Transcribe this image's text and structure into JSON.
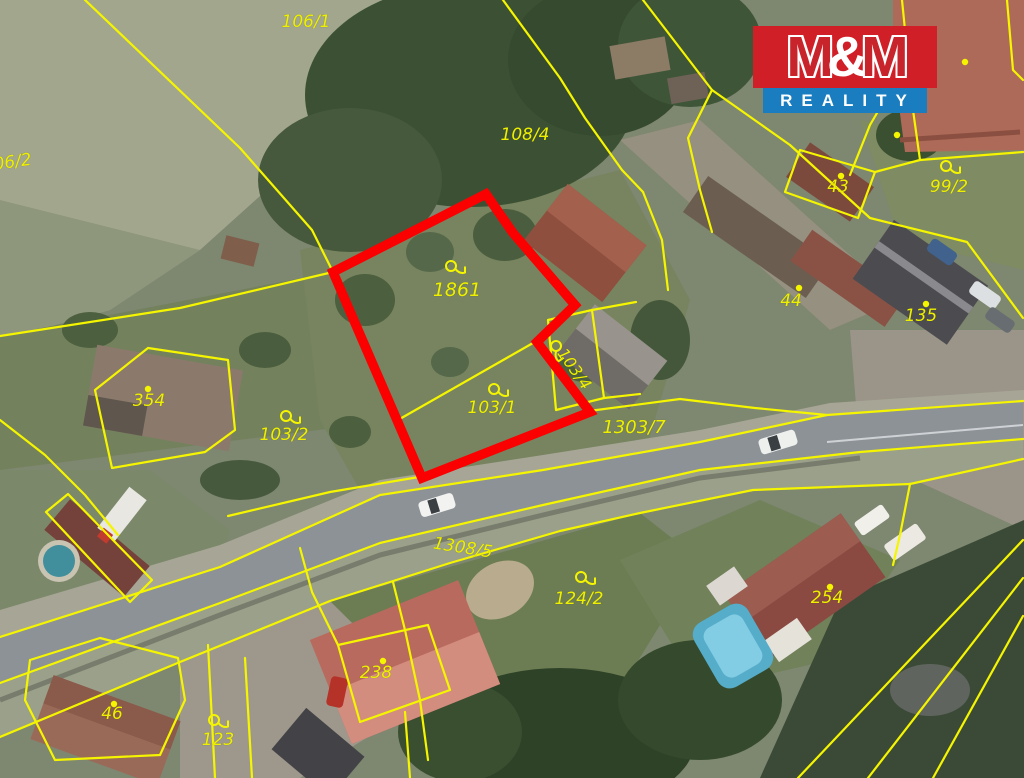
{
  "branding": {
    "m1": "M",
    "amp": "&",
    "m2": "M",
    "reality": "REALITY",
    "red": "#d01f26",
    "blue": "#1a7dc0"
  },
  "map": {
    "boundary_color": "#f5f500",
    "label_color": "#eef000",
    "highlight_parcel": {
      "number": "1861",
      "outline_color": "#fb0000",
      "points": "333,272 486,194 513,233 575,305 537,342 590,412 422,478"
    },
    "building_dots": [
      [
        965,
        62
      ],
      [
        897,
        135
      ]
    ],
    "parcel_labels": [
      {
        "text": "106/1",
        "x": 306,
        "y": 27,
        "rot": 0,
        "sym": "none",
        "size": 17
      },
      {
        "text": "106/2",
        "x": 8,
        "y": 168,
        "rot": -8,
        "sym": "none",
        "size": 17
      },
      {
        "text": "108/4",
        "x": 525,
        "y": 140,
        "rot": 0,
        "sym": "none",
        "size": 17
      },
      {
        "text": "1861",
        "x": 457,
        "y": 296,
        "rot": 0,
        "sym": "flag",
        "sx": 451,
        "sy": 266,
        "size": 19
      },
      {
        "text": "103/1",
        "x": 492,
        "y": 413,
        "rot": 0,
        "sym": "flag",
        "sx": 494,
        "sy": 389,
        "size": 17
      },
      {
        "text": "103/4",
        "x": 570,
        "y": 372,
        "rot": 55,
        "sym": "flag",
        "sx": 556,
        "sy": 346,
        "size": 16
      },
      {
        "text": "103/2",
        "x": 284,
        "y": 440,
        "rot": 0,
        "sym": "flag",
        "sx": 286,
        "sy": 416,
        "size": 17
      },
      {
        "text": "1303/7",
        "x": 634,
        "y": 433,
        "rot": 0,
        "sym": "none",
        "size": 18
      },
      {
        "text": "354",
        "x": 149,
        "y": 406,
        "rot": 0,
        "sym": "dot",
        "sx": 148,
        "sy": 389,
        "size": 17
      },
      {
        "text": "43",
        "x": 838,
        "y": 192,
        "rot": 0,
        "sym": "dot",
        "sx": 841,
        "sy": 176,
        "size": 17
      },
      {
        "text": "99/2",
        "x": 949,
        "y": 192,
        "rot": 0,
        "sym": "flag",
        "sx": 946,
        "sy": 166,
        "size": 17
      },
      {
        "text": "44",
        "x": 791,
        "y": 306,
        "rot": 0,
        "sym": "dot",
        "sx": 799,
        "sy": 288,
        "size": 17
      },
      {
        "text": "135",
        "x": 921,
        "y": 321,
        "rot": 0,
        "sym": "dot",
        "sx": 926,
        "sy": 304,
        "size": 17
      },
      {
        "text": "1308/5",
        "x": 462,
        "y": 553,
        "rot": 9,
        "sym": "none",
        "size": 17
      },
      {
        "text": "124/2",
        "x": 579,
        "y": 604,
        "rot": 0,
        "sym": "flag",
        "sx": 581,
        "sy": 577,
        "size": 17
      },
      {
        "text": "254",
        "x": 827,
        "y": 603,
        "rot": 0,
        "sym": "dot",
        "sx": 830,
        "sy": 587,
        "size": 17
      },
      {
        "text": "238",
        "x": 376,
        "y": 678,
        "rot": 0,
        "sym": "dot",
        "sx": 383,
        "sy": 661,
        "size": 17
      },
      {
        "text": "46",
        "x": 112,
        "y": 719,
        "rot": 0,
        "sym": "dot",
        "sx": 114,
        "sy": 704,
        "size": 17
      },
      {
        "text": "123",
        "x": 218,
        "y": 745,
        "rot": 0,
        "sym": "flag",
        "sx": 214,
        "sy": 720,
        "size": 17
      }
    ],
    "boundaries": [
      "85,0 240,148 312,230 333,272",
      "333,272 180,308 0,336",
      "503,0 560,78 585,118 622,170 643,192",
      "643,0 712,90",
      "712,90 790,145 870,218 967,242 1023,318",
      "712,90 688,138 700,190 712,232",
      "902,0 908,60 913,110 920,160",
      "908,60 870,125 850,175",
      "920,160 1023,152",
      "800,150 785,192 858,218 875,172 800,150",
      "398,420 533,343",
      "425,476 330,492 228,516",
      "589,411 680,399 755,408 827,415",
      "0,637 220,567 380,495 543,470 700,442 827,415 1023,401",
      "0,683 220,603 380,543 543,505 700,470 860,452 1023,439",
      "0,737 180,662 330,601 450,563 560,531 640,513 753,490 910,484",
      "910,484 900,535 893,565",
      "910,484 1023,459",
      "798,778 1023,540",
      "868,778 1023,578",
      "933,778 1023,616",
      "393,582 405,630 420,700 428,760",
      "208,645 215,778",
      "245,658 252,778",
      "95,390 148,348 228,360 235,430 205,452 112,468 95,390",
      "0,420 45,455 85,495 118,535",
      "548,320 592,310 604,398 556,410 548,320",
      "592,310 636,302",
      "604,398 640,394",
      "46,512 68,494 152,580 130,602 46,512",
      "300,548 312,592 338,645",
      "338,645 428,625 450,690 360,722 338,645",
      "405,712 410,778",
      "30,660 100,638 178,658 185,700 160,755 55,760 25,700 30,660",
      "875,172 920,160",
      "643,192 662,240 668,290",
      "1007,0 1013,70 1023,80"
    ]
  }
}
